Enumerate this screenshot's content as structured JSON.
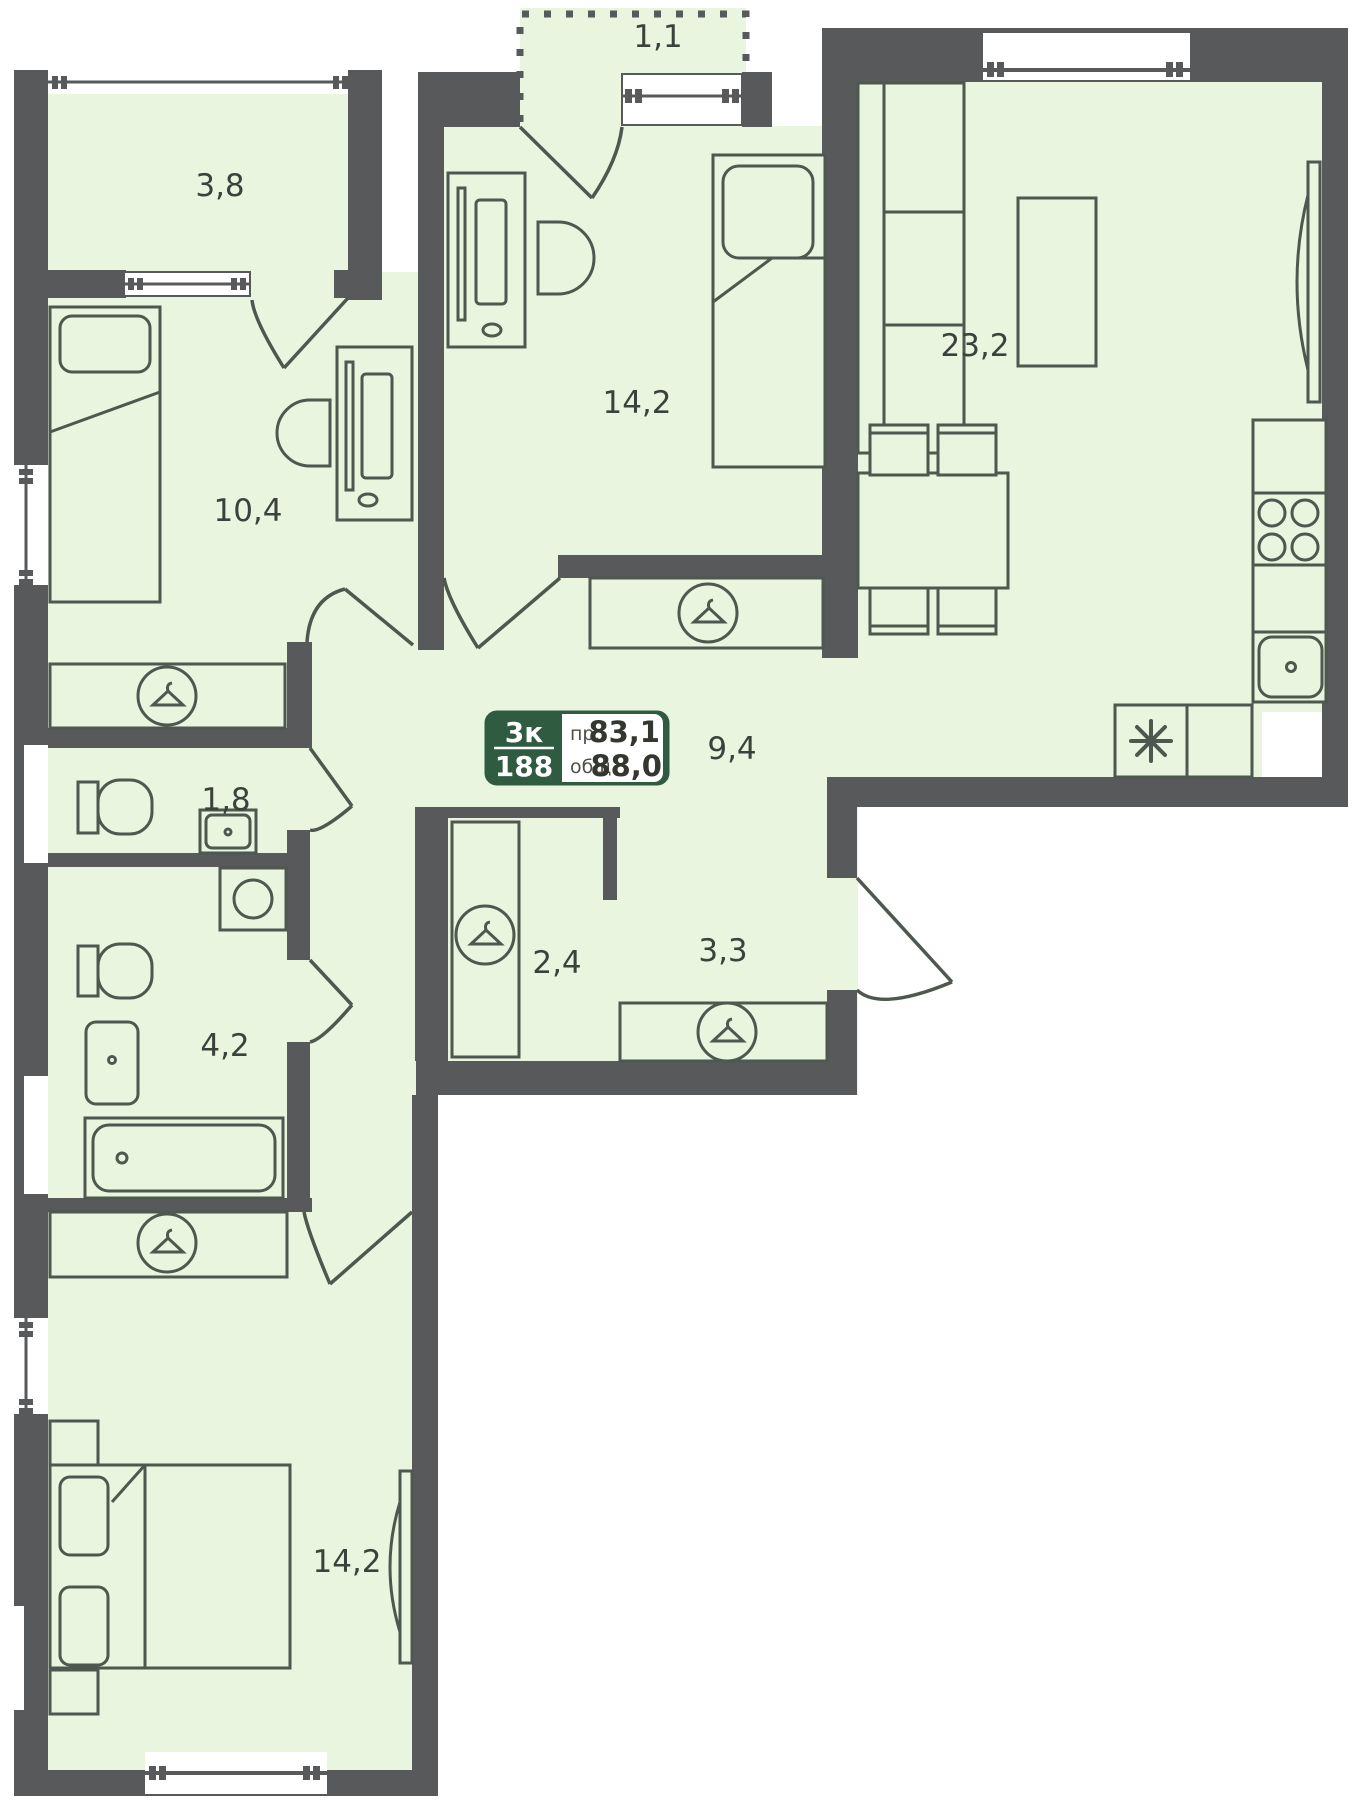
{
  "rooms": [
    {
      "name": "loggia-top-left",
      "area": "3,8"
    },
    {
      "name": "balcony-top",
      "area": "1,1"
    },
    {
      "name": "bedroom-top",
      "area": "14,2"
    },
    {
      "name": "bedroom-left",
      "area": "10,4"
    },
    {
      "name": "living-kitchen",
      "area": "23,2"
    },
    {
      "name": "hallway",
      "area": "9,4"
    },
    {
      "name": "wc",
      "area": "1,8"
    },
    {
      "name": "wardrobe-closet",
      "area": "2,4"
    },
    {
      "name": "entry-hall",
      "area": "3,3"
    },
    {
      "name": "bathroom",
      "area": "4,2"
    },
    {
      "name": "bedroom-bottom",
      "area": "14,2"
    }
  ],
  "info_box": {
    "room_count": "3к",
    "unit_number": "188",
    "label_projected": "пр.",
    "area_projected": "83,1",
    "label_total": "общ.",
    "area_total": "88,0"
  },
  "icons": {
    "wardrobe": "hanger",
    "kitchen_appliance": "asterisk-8-spoke"
  },
  "colors": {
    "wall": "#57595B",
    "floor": "#E9F5DF",
    "furniture_line": "#4E584E",
    "accent": "#2F5B40",
    "text": "#3A423C",
    "background": "#FFFFFF"
  }
}
